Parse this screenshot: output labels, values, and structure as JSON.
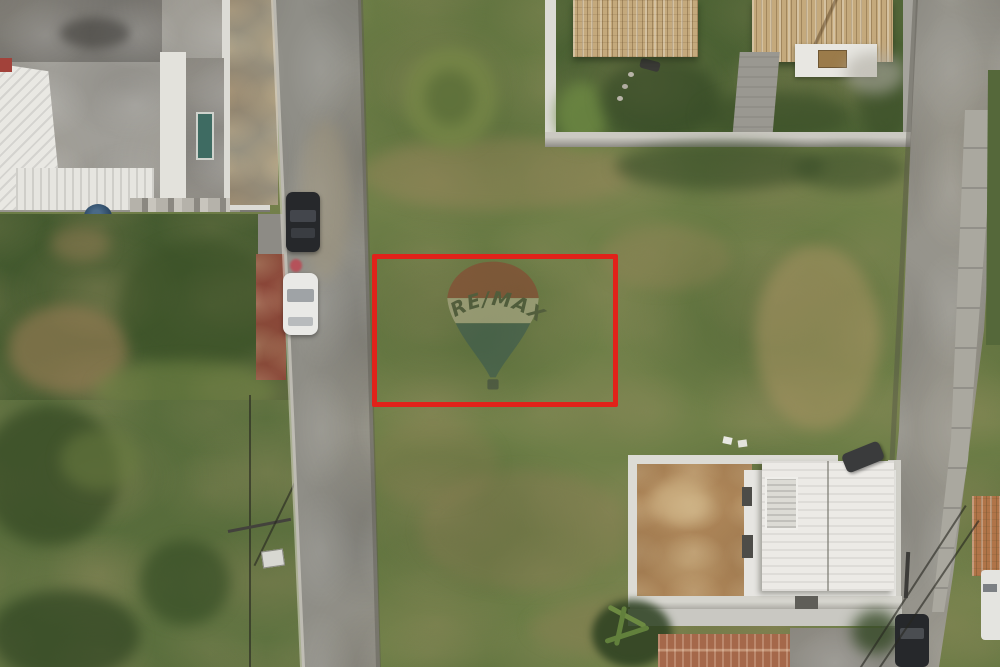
{
  "scene": {
    "description": "aerial-drone-photo-of-vacant-land-listing",
    "watermark": {
      "text": "RE/MAX"
    }
  },
  "watermark": {
    "text": "RE/MAX"
  },
  "colors": {
    "highlight": "#e1221a",
    "grass_base": "#6f7f48",
    "grass_dark": "#55683a",
    "veg_dark": "#42582e",
    "field": "#5e7240",
    "road": "#8f8e87",
    "road_edge": "#6e6d66",
    "concrete": "#a09e98",
    "concrete_dark": "#7b7974",
    "roof_white": "#eceae6",
    "tile_tan": "#c4a97c",
    "tile_dark": "#8f7449",
    "terracotta": "#a5684a",
    "wall_white": "#dcdbd5",
    "brick": "#8a4538",
    "dirt": "#ab8457",
    "tank_blue": "#2e4a66",
    "car_black": "#26282b",
    "car_white": "#e9e9e6",
    "balloon_red": "#8a4632",
    "balloon_band": "#b2af8e",
    "balloon_blue": "#3c5a50",
    "balloon_text": "#454f38"
  }
}
